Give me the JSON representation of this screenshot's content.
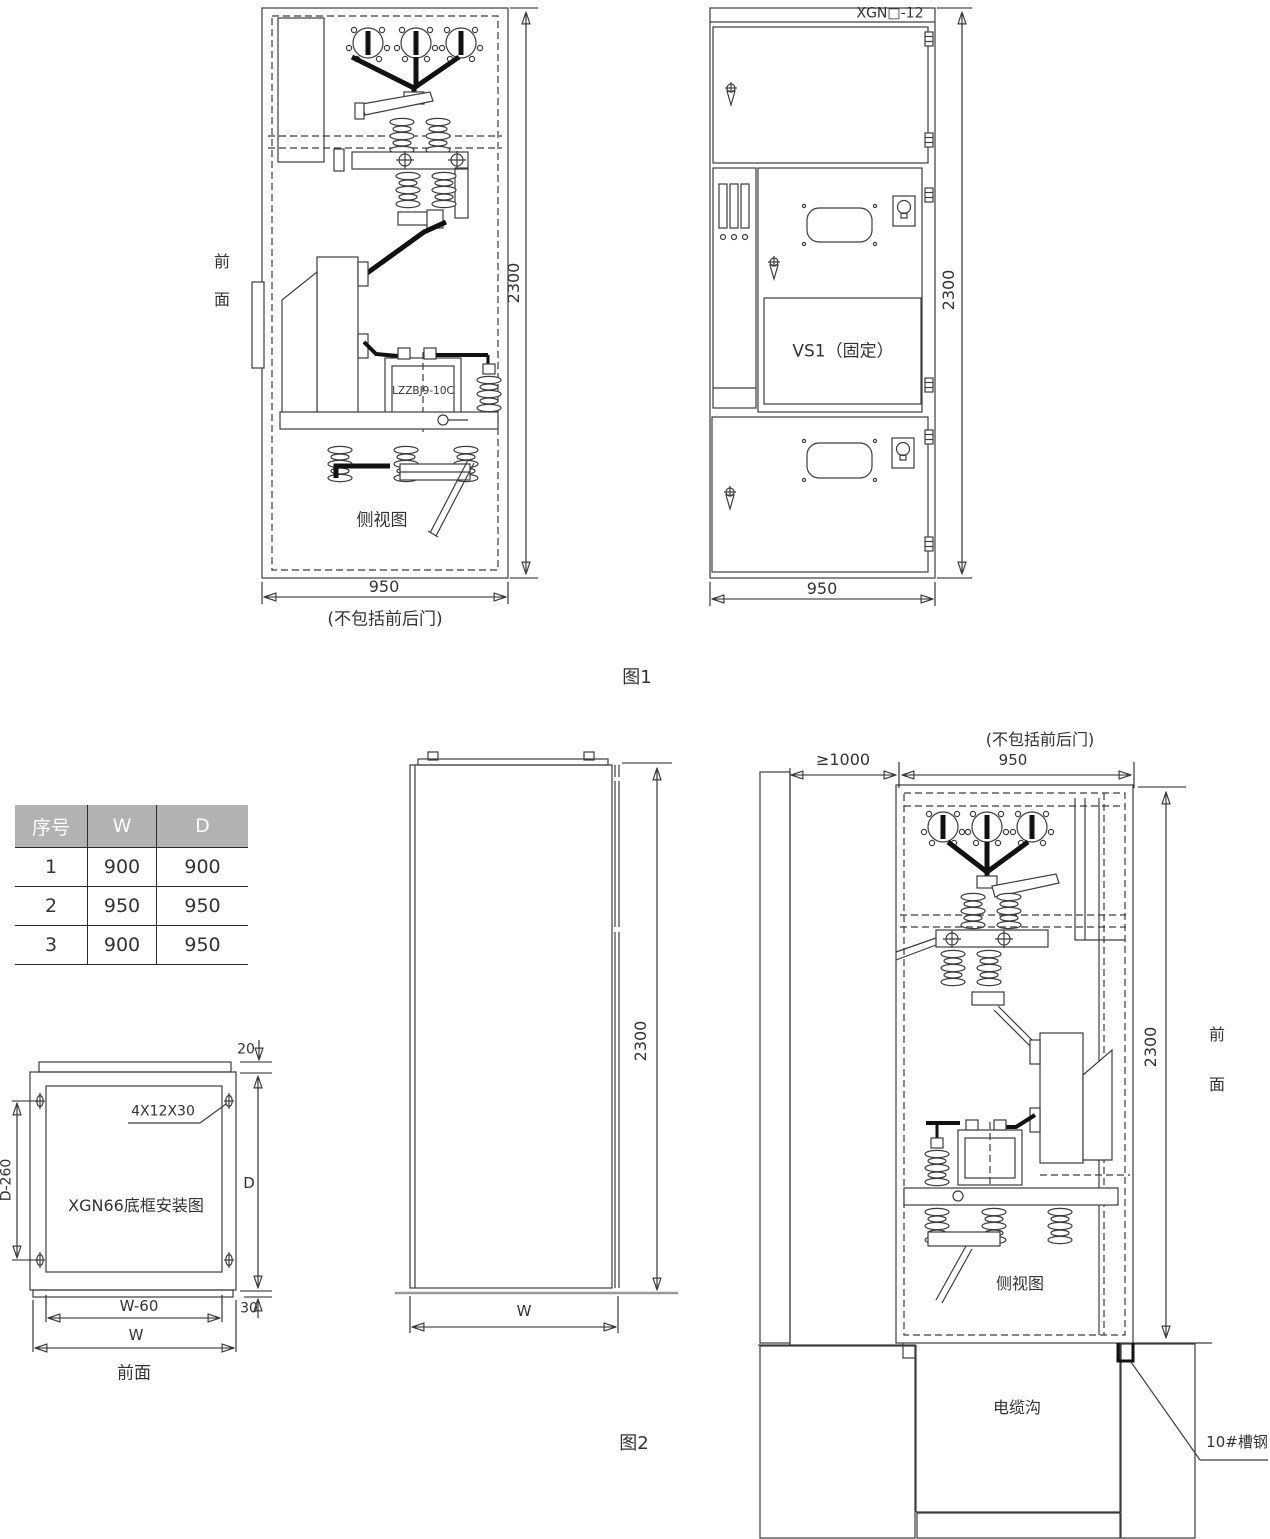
{
  "figure1": {
    "caption": "图1",
    "side_view": {
      "front_char_top": "前",
      "front_char_bottom": "面",
      "height_dim": "2300",
      "width_dim": "950",
      "width_note": "(不包括前后门)",
      "view_label": "侧视图",
      "ct_label": "LZZBJ9-10C"
    },
    "front_view": {
      "model_label": "XGN□-12",
      "breaker_label": "VS1（固定）",
      "height_dim": "2300",
      "width_dim": "950"
    }
  },
  "size_table": {
    "headers": [
      "序号",
      "W",
      "D"
    ],
    "rows": [
      [
        "1",
        "900",
        "900"
      ],
      [
        "2",
        "950",
        "950"
      ],
      [
        "3",
        "900",
        "950"
      ]
    ]
  },
  "figure2": {
    "caption": "图2",
    "base_frame": {
      "title": "XGN66底框安装图",
      "bolt_spec": "4X12X30",
      "top_dim": "20",
      "left_dim": "D-260",
      "right_dim": "D",
      "inner_width_dim": "W-60",
      "offset_dim": "30",
      "width_dim": "W",
      "front_label": "前面"
    },
    "outline_view": {
      "height_dim": "2300",
      "width_dim": "W"
    },
    "installation": {
      "wall_clearance_dim": "≥1000",
      "width_note": "(不包括前后门)",
      "width_dim": "950",
      "height_dim": "2300",
      "front_char_top": "前",
      "front_char_bottom": "面",
      "view_label": "侧视图",
      "trench_label": "电缆沟",
      "channel_steel_label": "10#槽钢"
    }
  }
}
